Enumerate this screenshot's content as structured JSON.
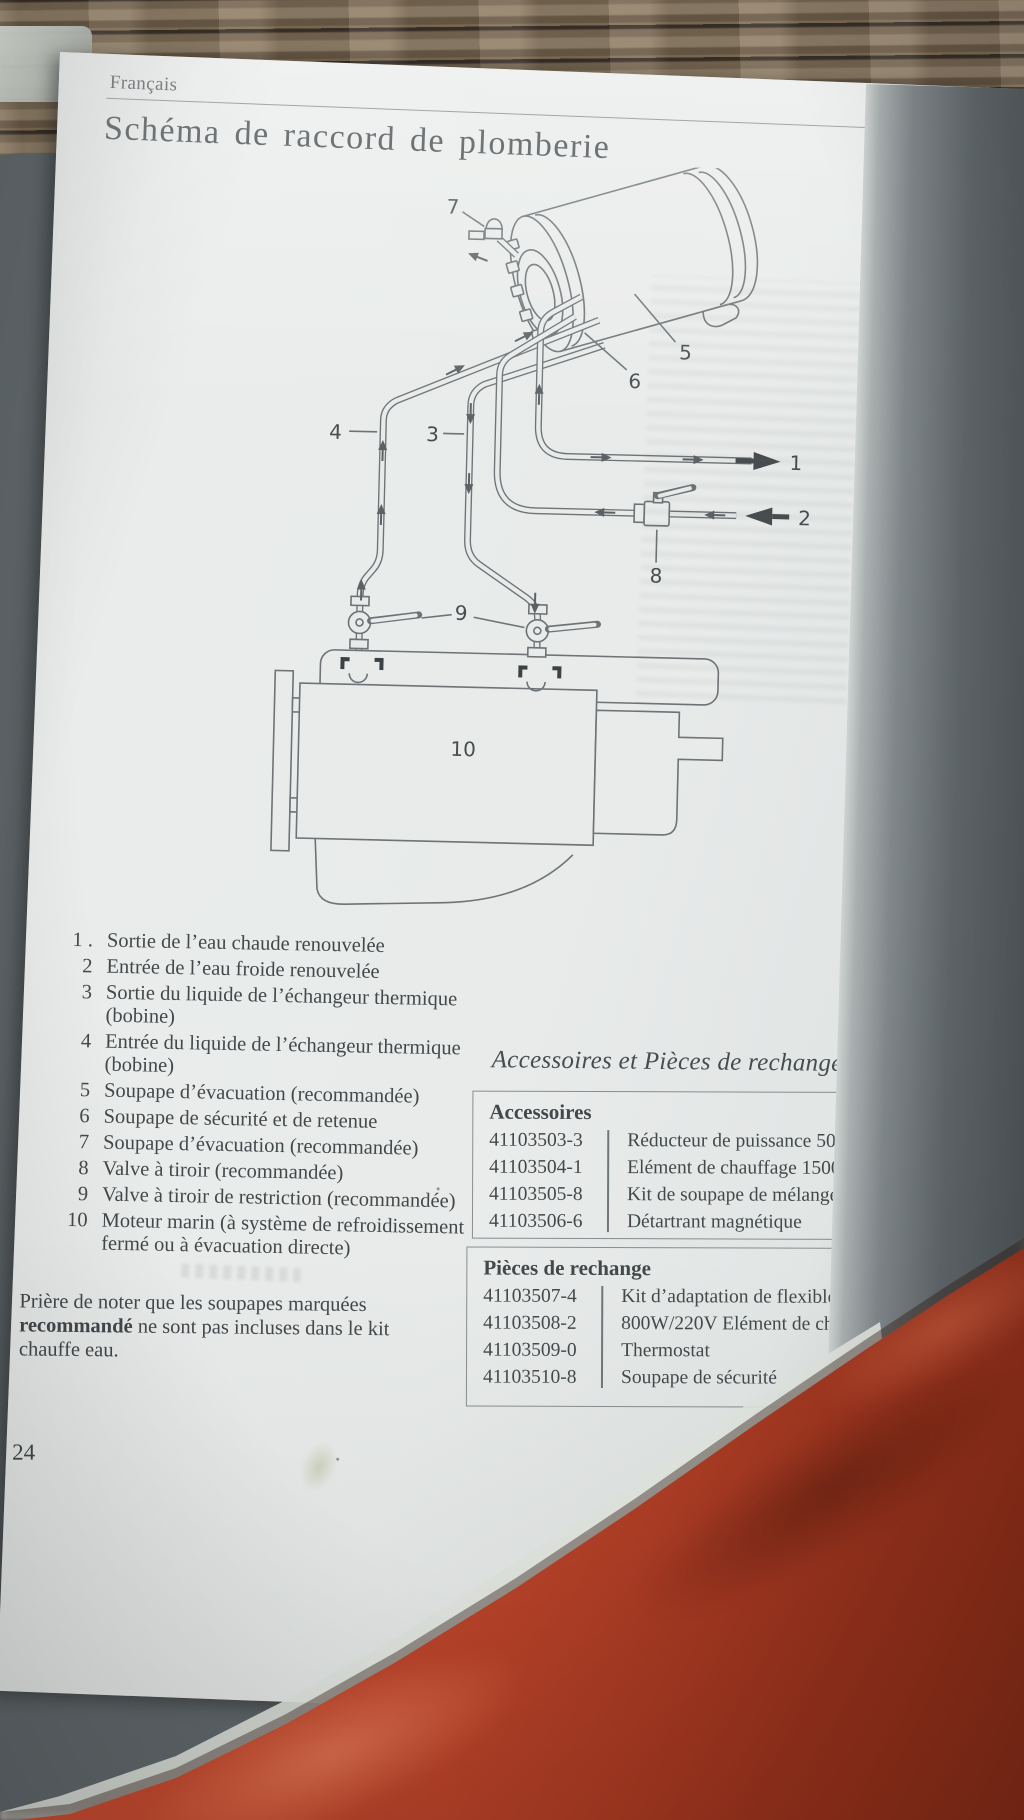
{
  "page": {
    "language_header": "Français",
    "title": "Schéma de raccord de plomberie",
    "page_number": "24"
  },
  "diagram": {
    "labels": [
      "1",
      "2",
      "3",
      "4",
      "5",
      "6",
      "7",
      "8",
      "9",
      "10"
    ]
  },
  "legend": {
    "items": [
      {
        "num": "1 .",
        "lines": [
          "Sortie de l’eau chaude renouvelée"
        ]
      },
      {
        "num": "2",
        "lines": [
          "Entrée de l’eau froide renouvelée"
        ]
      },
      {
        "num": "3",
        "lines": [
          "Sortie du liquide de l’échangeur thermique",
          "(bobine)"
        ]
      },
      {
        "num": "4",
        "lines": [
          "Entrée du liquide de l’échangeur thermique",
          "(bobine)"
        ]
      },
      {
        "num": "5",
        "lines": [
          "Soupape d’évacuation (recommandée)"
        ]
      },
      {
        "num": "6",
        "lines": [
          "Soupape de sécurité et de retenue"
        ]
      },
      {
        "num": "7",
        "lines": [
          "Soupape d’évacuation (recommandée)"
        ]
      },
      {
        "num": "8",
        "lines": [
          "Valve à tiroir (recommandée)"
        ]
      },
      {
        "num": "9",
        "lines": [
          "Valve à tiroir de restriction (recommandée)"
        ]
      },
      {
        "num": "10",
        "lines": [
          "Moteur marin (à système de refroidissement",
          "fermé ou à évacuation directe)"
        ]
      }
    ]
  },
  "note": {
    "line1": "Prière de noter que les soupapes marquées",
    "bold": "recommandé",
    "line2": " ne sont pas incluses dans le kit",
    "line3": "chauffe eau."
  },
  "parts": {
    "heading": "Accessoires et Pièces de rechange",
    "sections": [
      {
        "title": "Accessoires",
        "rows": [
          [
            "41103503-3",
            "Réducteur de puissance 50%"
          ],
          [
            "41103504-1",
            "Elément de chauffage 1500W/220V"
          ],
          [
            "41103505-8",
            "Kit de soupape de mélange thermostatique"
          ],
          [
            "41103506-6",
            "Détartrant magnétique"
          ]
        ]
      },
      {
        "title": "Pièces de rechange",
        "rows": [
          [
            "41103507-4",
            "Kit d’adaptation de flexible x 1/2\" x 16 mm"
          ],
          [
            "41103508-2",
            "800W/220V Elément de chauffage"
          ],
          [
            "41103509-0",
            "Thermostat"
          ],
          [
            "41103510-8",
            "Soupape de sécurité"
          ]
        ]
      }
    ]
  }
}
